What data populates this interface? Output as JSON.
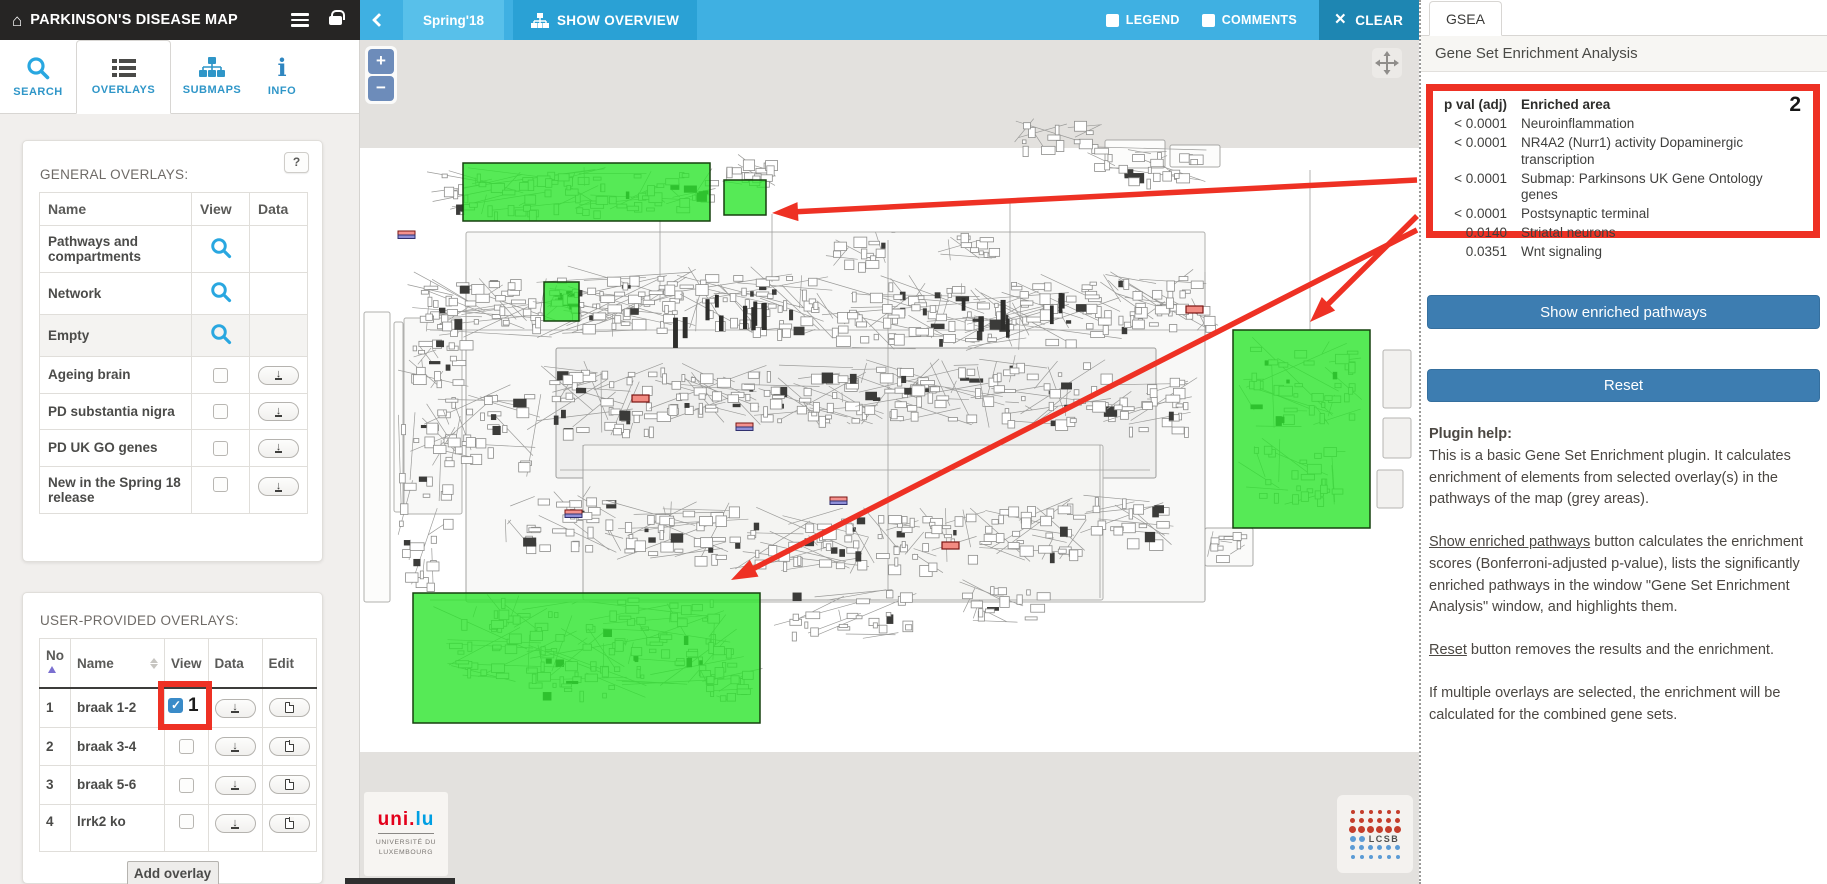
{
  "header": {
    "title": "PARKINSON'S DISEASE MAP"
  },
  "topbar": {
    "project_label": "Spring'18",
    "show_overview_label": "SHOW OVERVIEW",
    "legend_label": "LEGEND",
    "comments_label": "COMMENTS",
    "clear_label": "CLEAR"
  },
  "icons": {
    "home": "⌂",
    "menu": "hamburger",
    "lock": "padlock",
    "back": "chevron-left",
    "overview": "hierarchy-tree",
    "clear": "×",
    "search": "magnifier",
    "overlays": "list",
    "submaps": "hierarchy-tree",
    "info": "i",
    "help": "?",
    "view_zoom": "magnifier",
    "download": "↓",
    "edit": "document-page",
    "sort_asc": "▲",
    "sort_both": "▲▼",
    "zoom_in": "+",
    "zoom_out": "−",
    "pan": "crosshair-arrows"
  },
  "sidebar": {
    "tabs": [
      {
        "label": "SEARCH"
      },
      {
        "label": "OVERLAYS"
      },
      {
        "label": "SUBMAPS"
      },
      {
        "label": "INFO"
      }
    ],
    "general_overlays": {
      "title": "GENERAL OVERLAYS:",
      "help_button": "?",
      "columns": [
        "Name",
        "View",
        "Data"
      ],
      "rows": [
        {
          "name": "Pathways and compartments",
          "view": "magnifier"
        },
        {
          "name": "Network",
          "view": "magnifier"
        },
        {
          "name": "Empty",
          "view": "magnifier",
          "shaded": true
        },
        {
          "name": "Ageing brain",
          "view": "checkbox",
          "checked": false,
          "data": "download"
        },
        {
          "name": "PD substantia nigra",
          "view": "checkbox",
          "checked": false,
          "data": "download"
        },
        {
          "name": "PD UK GO genes",
          "view": "checkbox",
          "checked": false,
          "data": "download"
        },
        {
          "name": "New in the Spring 18 release",
          "view": "checkbox",
          "checked": false,
          "data": "download"
        }
      ]
    },
    "user_overlays": {
      "title": "USER-PROVIDED OVERLAYS:",
      "columns": [
        "No",
        "Name",
        "View",
        "Data",
        "Edit"
      ],
      "rows": [
        {
          "no": "1",
          "name": "braak 1-2",
          "checked": true,
          "annotation": "1"
        },
        {
          "no": "2",
          "name": "braak 3-4",
          "checked": false
        },
        {
          "no": "3",
          "name": "braak 5-6",
          "checked": false
        },
        {
          "no": "4",
          "name": "lrrk2 ko",
          "checked": false
        }
      ],
      "add_button": "Add overlay"
    }
  },
  "map": {
    "zoom_in": "+",
    "zoom_out": "−",
    "highlight_color": "#2ce52c",
    "annotation_color": "#ee3124",
    "highlights": [
      {
        "x": 103,
        "y": 123,
        "w": 247,
        "h": 58
      },
      {
        "x": 364,
        "y": 140,
        "w": 42,
        "h": 35
      },
      {
        "x": 184,
        "y": 242,
        "w": 35,
        "h": 39
      },
      {
        "x": 873,
        "y": 290,
        "w": 137,
        "h": 198
      },
      {
        "x": 53,
        "y": 553,
        "w": 347,
        "h": 130
      }
    ],
    "arrows": [
      {
        "x1": 1057,
        "y1": 140,
        "x2": 412,
        "y2": 173
      },
      {
        "x1": 1057,
        "y1": 176,
        "x2": 950,
        "y2": 282
      },
      {
        "x1": 1057,
        "y1": 190,
        "x2": 371,
        "y2": 540
      }
    ],
    "logos": {
      "unilu_red": "uni.",
      "unilu_blue": "lu",
      "unilu_caption_1": "UNIVERSITÉ DU",
      "unilu_caption_2": "LUXEMBOURG",
      "lcsb": "LCSB"
    }
  },
  "gsea": {
    "tab": "GSEA",
    "title": "Gene Set Enrichment Analysis",
    "annotation": "2",
    "table": {
      "col_p": "p val (adj)",
      "col_area": "Enriched area",
      "rows": [
        {
          "p": "< 0.0001",
          "area": "Neuroinflammation"
        },
        {
          "p": "< 0.0001",
          "area": "NR4A2 (Nurr1) activity Dopaminergic transcription"
        },
        {
          "p": "< 0.0001",
          "area": "Submap: Parkinsons UK Gene Ontology genes"
        },
        {
          "p": "< 0.0001",
          "area": "Postsynaptic terminal"
        },
        {
          "p": "0.0140",
          "area": "Striatal neurons"
        },
        {
          "p": "0.0351",
          "area": "Wnt signaling"
        }
      ]
    },
    "show_button": "Show enriched pathways",
    "reset_button": "Reset",
    "help": {
      "label": "Plugin help:",
      "p1": "This is a basic Gene Set Enrichment plugin. It calculates enrichment of elements from selected overlay(s) in the pathways of the map (grey areas).",
      "p2_link": "Show enriched pathways",
      "p2_rest": " button calculates the enrichment scores (Bonferroni-adjusted p-value), lists the significantly enriched pathways in the window \"Gene Set Enrichment Analysis\" window, and highlights them.",
      "p3_link": "Reset",
      "p3_rest": " button removes the results and the enrichment.",
      "p4": "If multiple overlays are selected, the enrichment will be calculated for the combined gene sets."
    }
  }
}
